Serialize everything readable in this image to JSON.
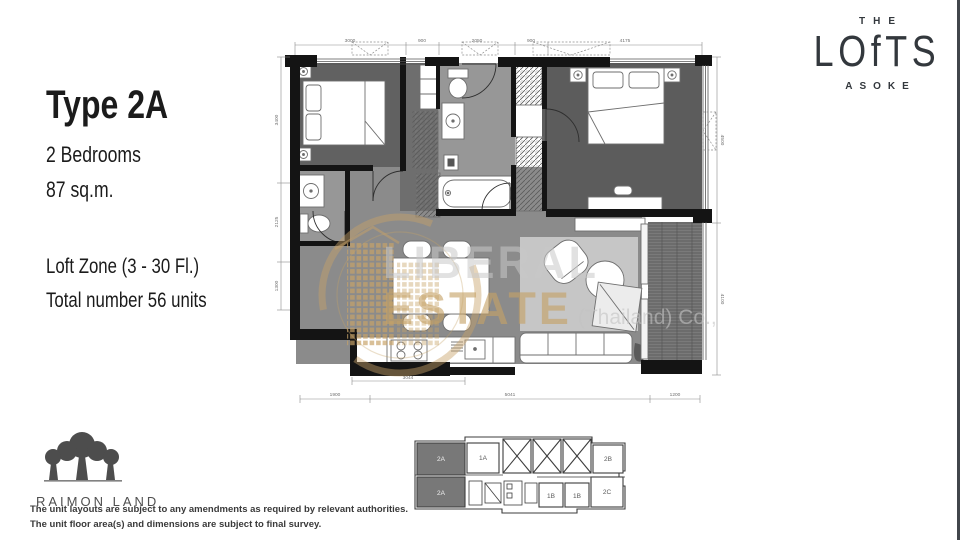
{
  "page": {
    "width": 960,
    "height": 540,
    "background": "#ffffff"
  },
  "title_block": {
    "type": "Type 2A",
    "bedrooms": "2 Bedrooms",
    "area": "87 sq.m.",
    "zone": "Loft Zone (3 - 30 Fl.)",
    "total": "Total number  56 units"
  },
  "brand_logo": {
    "the": "THE",
    "name": "LOfTS",
    "sub": "ASOKE"
  },
  "watermark": {
    "word1": "LIBERAL",
    "word2": "ESTATE",
    "word3": "(Thailand) Co.,",
    "gold": "#c7a268"
  },
  "floorplan": {
    "dims": {
      "top": [
        "3000",
        "900",
        "2050",
        "900",
        "4175"
      ],
      "left": [
        "3400",
        "2125",
        "1300"
      ],
      "right": [
        "4500",
        "4100"
      ],
      "bottom_inner": [
        "3044"
      ],
      "bottom_outer": [
        "1900",
        "5041",
        "1200"
      ]
    }
  },
  "keyplan": {
    "units": [
      "2A",
      "1A",
      "2B",
      "2A",
      "1B",
      "1B",
      "2C"
    ]
  },
  "developer": {
    "name": "RAIMON LAND"
  },
  "disclaimer": {
    "line1": "The unit layouts are subject to any amendments as required by relevant authorities.",
    "line2": "The unit floor area(s) and dimensions are subject to final survey."
  },
  "colors": {
    "wall": "#141414",
    "bedroom_floor": "#5e5e5e",
    "living_floor": "#8b8b8b",
    "bath_floor": "#979797",
    "rug": "#c6c6c6",
    "balcony": "#7a7a7a",
    "gold": "#c7a268",
    "logo": "#33383d"
  }
}
